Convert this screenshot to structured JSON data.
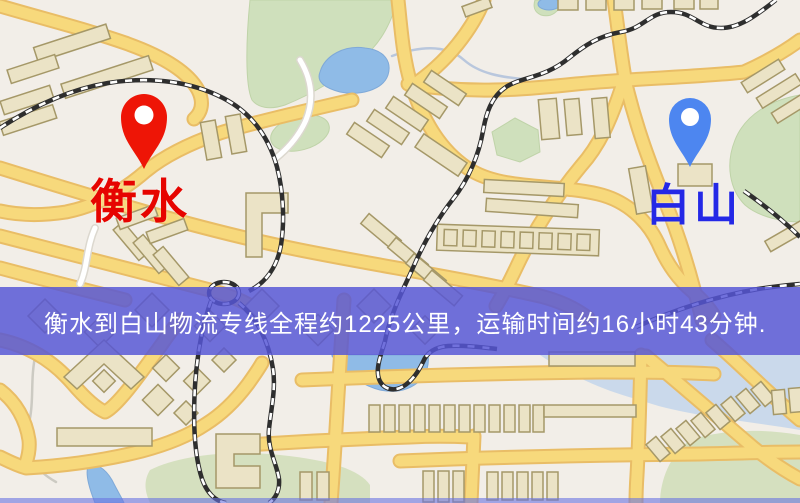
{
  "banner": {
    "text": "衡水到白山物流专线全程约1225公里，运输时间约16小时43分钟.",
    "background_color": "#5656d5",
    "text_color": "#ffffff"
  },
  "origin": {
    "label": "衡水",
    "pin_color": "#ee1506",
    "label_color": "#e60400"
  },
  "destination": {
    "label": "白山",
    "pin_color": "#4d86f0",
    "label_color": "#2428e6"
  },
  "route_facts": {
    "distance_text": "约1225公里",
    "duration_text": "约16小时43分钟"
  },
  "map_palette": {
    "background": "#f2eee8",
    "road": "#f7d97c",
    "road_casing": "#e9bd66",
    "building_fill": "#ebe3c6",
    "building_stroke": "#a59868",
    "water": "#8fbbe7",
    "park": "#cfe0bc",
    "railway": "#2e2e2e"
  }
}
